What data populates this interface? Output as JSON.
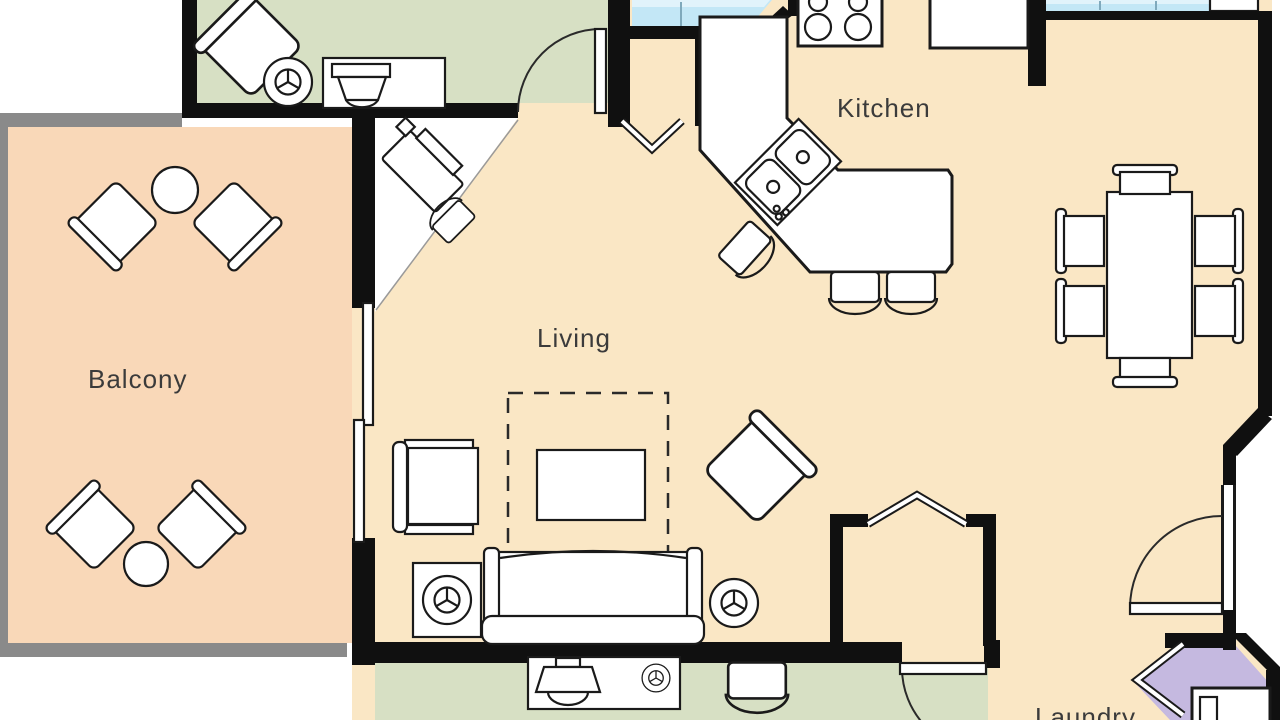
{
  "plan": {
    "title": "Condo unit floor plan (cropped view)",
    "rooms": {
      "balcony": {
        "label": "Balcony"
      },
      "living": {
        "label": "Living"
      },
      "kitchen": {
        "label": "Kitchen"
      },
      "laundry": {
        "label": "Laundry"
      }
    },
    "colors": {
      "floor_main": "#fae7c5",
      "floor_balcony": "#f9d8b8",
      "floor_bedroom": "#d7e0c4",
      "floor_laundry": "#c5b9e0",
      "balcony_rail": "#8a8a8a",
      "wall": "#101010",
      "counter_cyan": "#c3e7f6",
      "counter_cyan_light": "#e1f3fb",
      "furniture_fill": "#ffffff",
      "furniture_stroke": "#1a1a1a",
      "label_color": "#3b3b3b"
    }
  }
}
